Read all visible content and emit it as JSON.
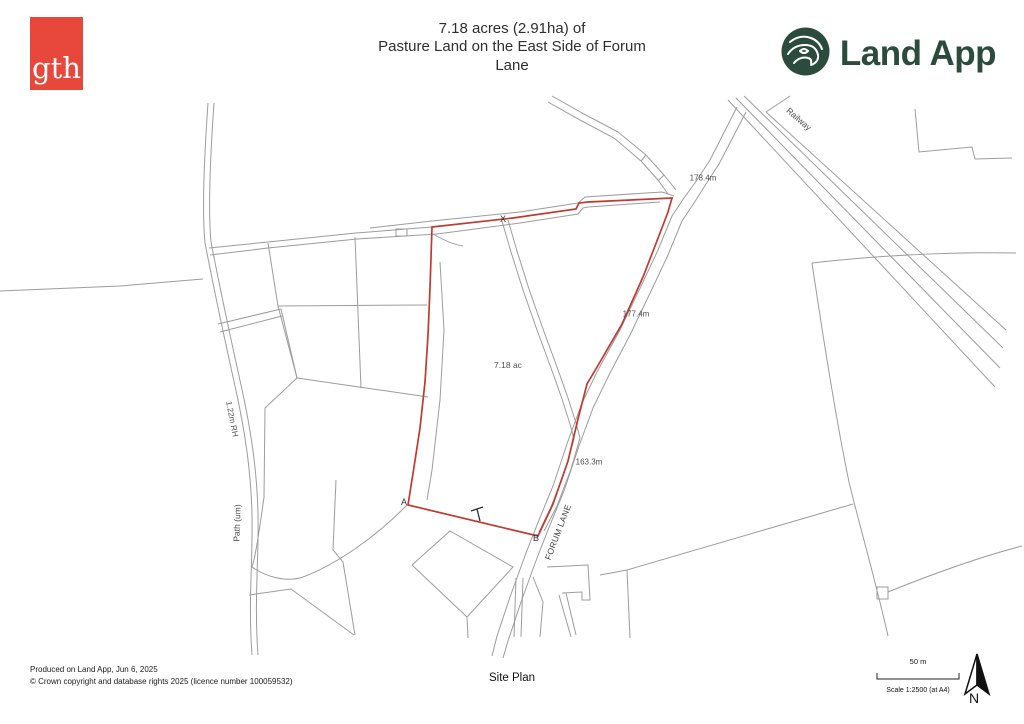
{
  "header": {
    "logo_text": "gth",
    "title": {
      "line1": "7.18 acres (2.91ha) of",
      "line2": "Pasture Land on the East Side of Forum",
      "line3": "Lane"
    },
    "brand": "Land App"
  },
  "map": {
    "area_label": "7.18 ac",
    "marker_x": "X",
    "marker_a": "A",
    "marker_b": "B",
    "dim_north": "178.4m",
    "dim_east": "177.4m",
    "dim_southeast": "163.3m",
    "road_label": "FORUM LANE",
    "railway_label": "Railway",
    "path_label": "Path (um)",
    "hedge_label": "1.22m RH",
    "colors": {
      "parcel_boundary": "#bf3a30",
      "map_lines": "#9c9c9c",
      "gth_red": "#e8473b",
      "landapp_green": "#2b4c3c"
    }
  },
  "footer": {
    "produced": "Produced on Land App, Jun 6, 2025",
    "copyright": "© Crown copyright and database rights 2025 (licence number 100059532)",
    "plan_name": "Site Plan",
    "scale_bar_label": "50 m",
    "scale_text": "Scale 1:2500 (at A4)",
    "north": "N"
  }
}
